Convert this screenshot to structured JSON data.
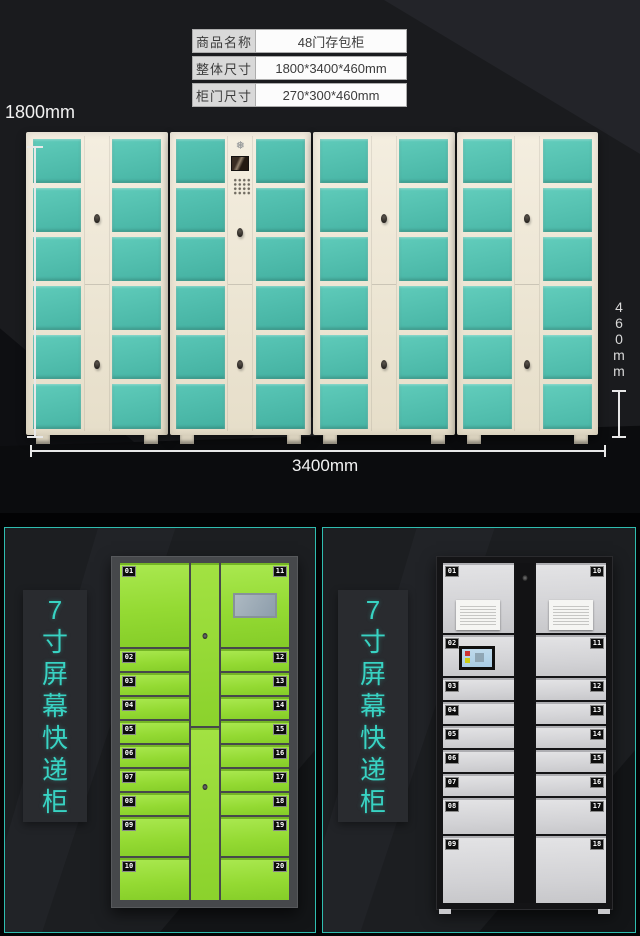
{
  "colors": {
    "accent_teal": "#38d3c3",
    "panel_border": "#2fbdb0",
    "main_door_teal": "#52c2b2",
    "main_frame_cream": "#efe8d7",
    "green_door": "#94da33",
    "white_door": "#d8d8da",
    "dimension_line": "#e8e8e8",
    "background_dark": "#1a1b1e"
  },
  "icons": {
    "snowflake": "❅"
  },
  "spec_table": {
    "rows": [
      {
        "label": "商品名称",
        "value": "48门存包柜"
      },
      {
        "label": "整体尺寸",
        "value": "1800*3400*460mm"
      },
      {
        "label": "柜门尺寸",
        "value": "270*300*460mm"
      }
    ]
  },
  "dimensions": {
    "height": "1800mm",
    "width": "3400mm",
    "depth": "460mm"
  },
  "main_locker": {
    "units": 4,
    "rows_per_unit": 6,
    "door_columns_per_unit": 2,
    "control_unit_index": 1,
    "total_doors": 48
  },
  "panels": [
    {
      "caption": "7寸屏幕快递柜",
      "style": "green",
      "mid_doors": 2,
      "left_doors": [
        {
          "num": "01",
          "size": "xl"
        },
        {
          "num": "02",
          "size": "s"
        },
        {
          "num": "03",
          "size": "s"
        },
        {
          "num": "04",
          "size": "s"
        },
        {
          "num": "05",
          "size": "s"
        },
        {
          "num": "06",
          "size": "s"
        },
        {
          "num": "07",
          "size": "s"
        },
        {
          "num": "08",
          "size": "s"
        },
        {
          "num": "09",
          "size": "m"
        },
        {
          "num": "10",
          "size": "l"
        }
      ],
      "right_doors": [
        {
          "num": "11",
          "size": "xl",
          "feature": "screen"
        },
        {
          "num": "12",
          "size": "s"
        },
        {
          "num": "13",
          "size": "s"
        },
        {
          "num": "14",
          "size": "s"
        },
        {
          "num": "15",
          "size": "s"
        },
        {
          "num": "16",
          "size": "s"
        },
        {
          "num": "17",
          "size": "s"
        },
        {
          "num": "18",
          "size": "s"
        },
        {
          "num": "19",
          "size": "m"
        },
        {
          "num": "20",
          "size": "l"
        }
      ]
    },
    {
      "caption": "7寸屏幕快递柜",
      "style": "white",
      "mid_doors": 0,
      "left_doors": [
        {
          "num": "01",
          "size": "xl",
          "feature": "notice"
        },
        {
          "num": "02",
          "size": "l",
          "feature": "screen"
        },
        {
          "num": "03",
          "size": "s"
        },
        {
          "num": "04",
          "size": "s"
        },
        {
          "num": "05",
          "size": "s"
        },
        {
          "num": "06",
          "size": "s"
        },
        {
          "num": "07",
          "size": "s"
        },
        {
          "num": "08",
          "size": "m"
        },
        {
          "num": "09",
          "size": "xl2"
        }
      ],
      "right_doors": [
        {
          "num": "10",
          "size": "xl",
          "feature": "notice"
        },
        {
          "num": "11",
          "size": "l"
        },
        {
          "num": "12",
          "size": "s"
        },
        {
          "num": "13",
          "size": "s"
        },
        {
          "num": "14",
          "size": "s"
        },
        {
          "num": "15",
          "size": "s"
        },
        {
          "num": "16",
          "size": "s"
        },
        {
          "num": "17",
          "size": "m"
        },
        {
          "num": "18",
          "size": "xl2"
        }
      ]
    }
  ]
}
